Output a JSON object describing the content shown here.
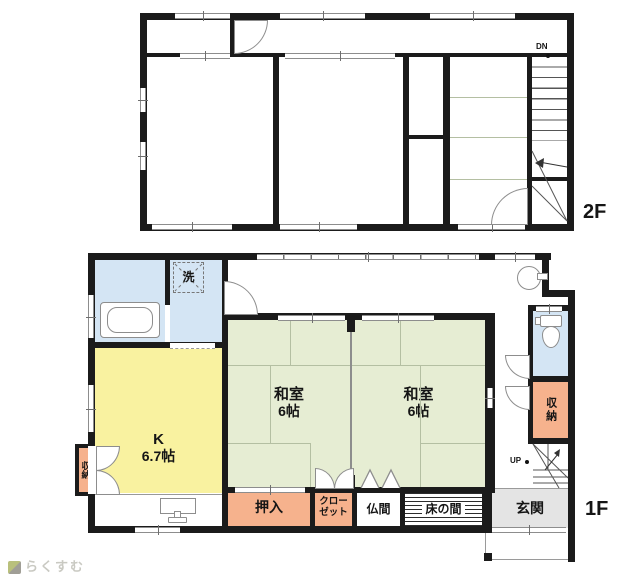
{
  "colors": {
    "wall": "#1b1b1b",
    "western_room": "#ECCAED",
    "tatami_room": "#E6EDD3",
    "closet": "#F6B28D",
    "kitchen": "#F9F2A0",
    "wet_area": "#D4E5F4",
    "entrance": "#E4E4E4"
  },
  "floor2": {
    "label": "2F",
    "stair_direction": "DN",
    "oshiire_top": "押入",
    "western_room_1": {
      "name": "洋室",
      "size": "6帖"
    },
    "western_room_2": {
      "name": "洋室",
      "size": "6帖"
    },
    "oshiire_right_upper": "押入",
    "oshiire_right_lower": "押入",
    "japanese_room": {
      "name": "和室",
      "size": "4帖"
    },
    "closet": "クローゼット"
  },
  "floor1": {
    "label": "1F",
    "stair_direction": "UP",
    "washing_machine": "洗",
    "kitchen": {
      "name": "K",
      "size": "6.7帖"
    },
    "japanese_room_1": {
      "name": "和室",
      "size": "6帖"
    },
    "japanese_room_2": {
      "name": "和室",
      "size": "6帖"
    },
    "storage_left": "収納",
    "storage_right": "収納",
    "oshiire": "押入",
    "closet": "クローゼット",
    "butsuma": "仏間",
    "tokonoma": "床の間",
    "genkan": "玄関"
  },
  "logo": {
    "text": "らくすむ"
  }
}
